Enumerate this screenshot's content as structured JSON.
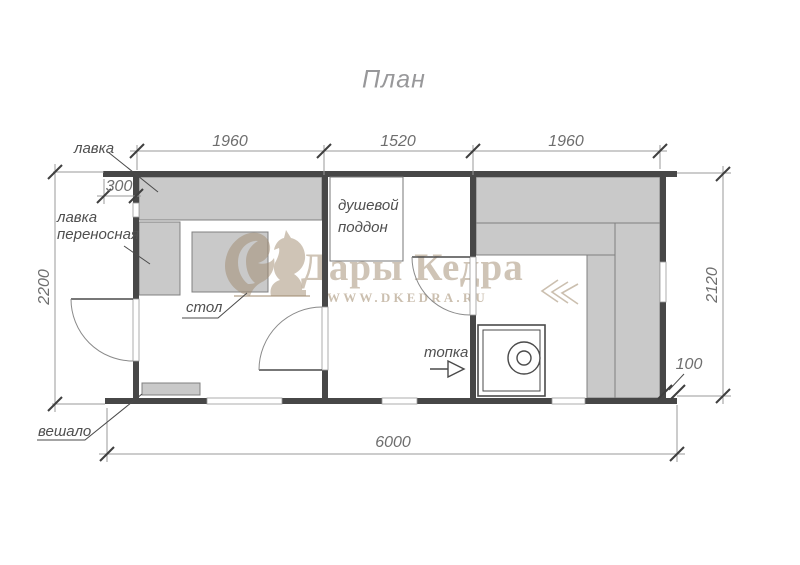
{
  "title": "План",
  "dimensions": {
    "top_segments": [
      "1960",
      "1520",
      "1960"
    ],
    "left_height": "2200",
    "right_height": "2120",
    "bottom_total": "6000",
    "left_offset": "300",
    "right_offset": "100"
  },
  "labels": {
    "bench": "лавка",
    "portable_bench_line1": "лавка",
    "portable_bench_line2": "переносная",
    "table": "стол",
    "shower_line1": "душевой",
    "shower_line2": "поддон",
    "firebox": "топка",
    "hanger": "вешало"
  },
  "watermark": {
    "brand": "Дары Кедра",
    "url": "WWW.DKEDRA.RU"
  },
  "colors": {
    "wall": "#474747",
    "bench_fill": "#c9c9c9",
    "bench_stroke": "#808080",
    "dimension_line": "#9a9a9a",
    "dimension_text": "#6e6e6e",
    "label_text": "#4f4f4f",
    "title_text": "#98989a",
    "watermark": "rgba(160,138,110,0.5)"
  }
}
